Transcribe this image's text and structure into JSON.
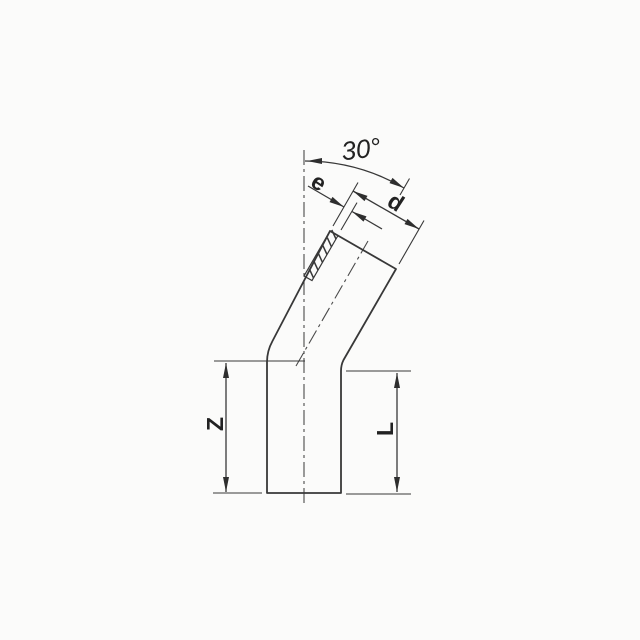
{
  "drawing": {
    "labels": {
      "angle": "30°",
      "wall_thickness": "e",
      "diameter": "d",
      "z_length": "Z",
      "l_length": "L"
    },
    "colors": {
      "line": "#383838",
      "text": "#222222",
      "background": "#fbfbfa"
    }
  }
}
